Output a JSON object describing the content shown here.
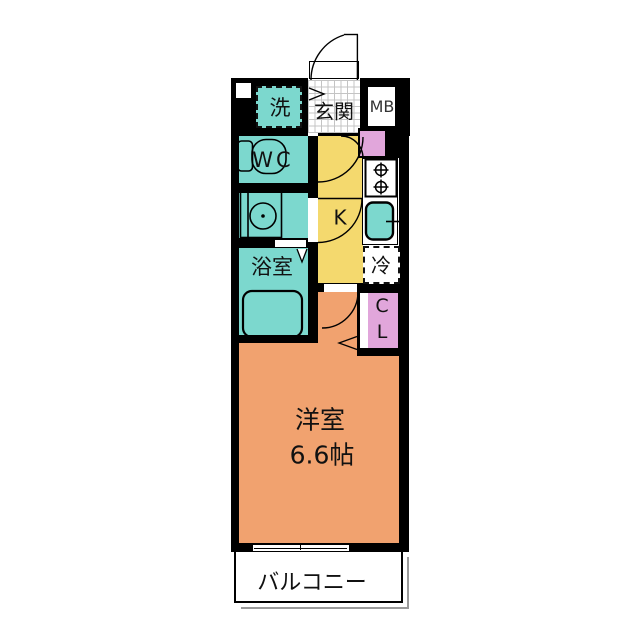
{
  "rooms": {
    "washer": "洗",
    "entrance": "玄関",
    "meter_box": "MB",
    "wc": "WC",
    "kitchen": "K",
    "bathroom": "浴室",
    "refrigerator": "冷",
    "closet": "C\nL",
    "main_room_name": "洋室",
    "main_room_size": "6.6帖",
    "balcony": "バルコニー"
  },
  "colors": {
    "wall": "#000000",
    "wet": "#7cd8ce",
    "kitchen": "#f4d96e",
    "room": "#f1a26f",
    "closet-pink": "#e1a6db",
    "tile-line": "#c4c4c4",
    "shadow": "#9a9a9a"
  }
}
